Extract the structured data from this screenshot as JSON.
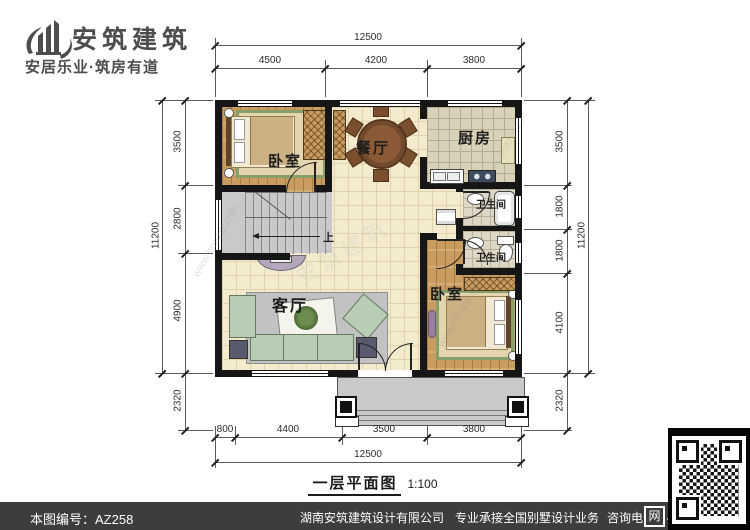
{
  "header": {
    "brand": "安筑建筑",
    "tagline": "安居乐业·筑房有道"
  },
  "rooms": {
    "bedroom1": "卧室",
    "dining": "餐厅",
    "kitchen": "厨房",
    "bath1": "卫生间",
    "bath2": "卫生间",
    "living": "客厅",
    "bedroom2": "卧室",
    "stairs_up": "上"
  },
  "dims": {
    "top": {
      "overall": "12500",
      "seg": [
        "4500",
        "4200",
        "3800"
      ]
    },
    "bottom": {
      "overall": "12500",
      "seg": [
        "800",
        "4400",
        "3500",
        "3800"
      ]
    },
    "left": {
      "overall": "11200",
      "seg": [
        "3500",
        "2800",
        "4900",
        "2320"
      ]
    },
    "right": {
      "overall": "11200",
      "seg": [
        "3500",
        "1800",
        "1800",
        "4100",
        "2320"
      ]
    }
  },
  "caption": {
    "title": "一层平面图",
    "scale": "1:100"
  },
  "watermarks": {
    "site": "www.hnazjz.com",
    "brand": "安筑建筑"
  },
  "footer": {
    "drawing_no": "本图编号：AZ258",
    "company": "湖南安筑建筑设计有限公司",
    "service": "专业承接全国别墅设计业务",
    "phone": "咨询电话：400-8070-511",
    "web_badge": "网"
  },
  "colors": {
    "wall": "#161616",
    "floor_hall": "#f4ebcf",
    "floor_wood": "#c99c60",
    "floor_tile": "#d9d2ba",
    "stair_gray": "#c9c9c9",
    "footer_bar": "#3d3d3d"
  }
}
